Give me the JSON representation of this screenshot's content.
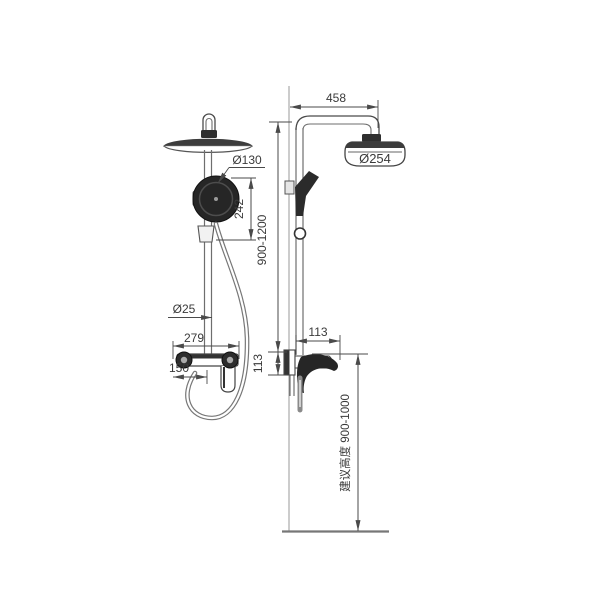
{
  "drawing": {
    "type": "shower-column-technical-drawing",
    "labels": {
      "arm_reach": "458",
      "head_diameter": "Ø254",
      "hand_shower_diameter": "Ø130",
      "hand_shower_span": "242",
      "riser_height_range": "900-1200",
      "pipe_diameter": "Ø25",
      "mixer_width": "279",
      "mixer_center_offset": "150",
      "mixer_depth": "113",
      "mixer_height": "113",
      "install_height": "建议高度 900-1000"
    },
    "colors": {
      "line": "#4a4a4a",
      "dark_fill": "#2b2b2b",
      "light_line": "#8a8a8a",
      "background": "#ffffff"
    }
  }
}
